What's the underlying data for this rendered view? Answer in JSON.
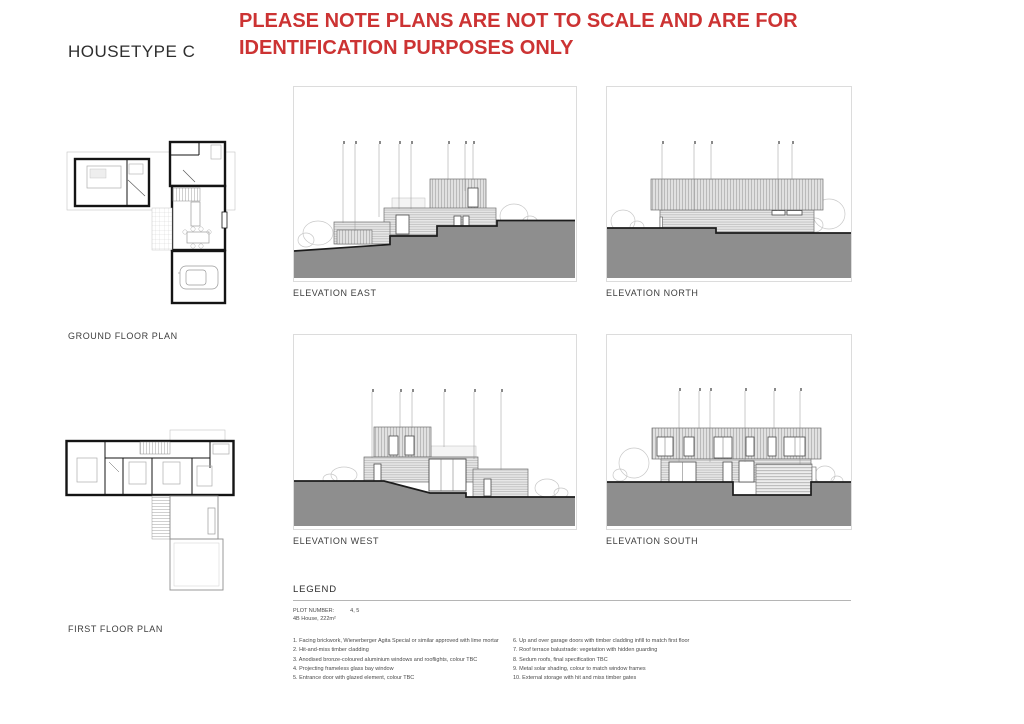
{
  "page": {
    "title": "HOUSETYPE C",
    "notice": "PLEASE NOTE PLANS ARE NOT TO SCALE AND ARE FOR IDENTIFICATION PURPOSES ONLY",
    "notice_color": "#cc3333"
  },
  "plans": [
    {
      "label": "GROUND FLOOR PLAN"
    },
    {
      "label": "FIRST FLOOR PLAN"
    }
  ],
  "elevations": [
    {
      "label": "ELEVATION EAST"
    },
    {
      "label": "ELEVATION NORTH"
    },
    {
      "label": "ELEVATION WEST"
    },
    {
      "label": "ELEVATION SOUTH"
    }
  ],
  "legend": {
    "heading": "LEGEND",
    "plot_number_label": "PLOT NUMBER:",
    "plot_number_value": "4, 5",
    "house_info": "4B House, 222m²",
    "items_left": [
      "1. Facing brickwork, Wienerberger Agita Special or similar approved with lime mortar",
      "2. Hit-and-miss timber cladding",
      "3. Anodised bronze-coloured aluminium windows and rooflights, colour TBC",
      "4. Projecting frameless glass bay window",
      "5. Entrance door with glazed element, colour TBC"
    ],
    "items_right": [
      "6. Up and over garage doors with timber cladding infill to match first floor",
      "7. Roof terrace balustrade: vegetation with hidden guarding",
      "8. Sedum roofs, final specification TBC",
      "9. Metal solar shading, colour to match window frames",
      "10. External storage with hit and miss timber gates"
    ]
  },
  "colors": {
    "ground_gray": "#8e8e8e",
    "hatch_line": "#9a9a9a",
    "wall_black": "#141414",
    "label_gray": "#3d3d3d"
  }
}
